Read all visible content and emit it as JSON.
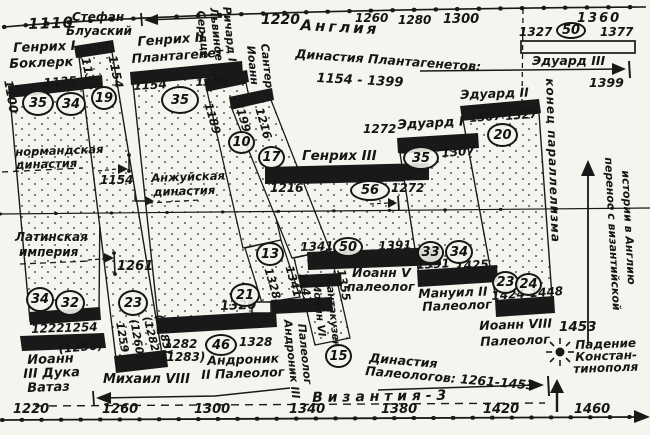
{
  "top_axis": {
    "region_label": "Англия",
    "ticks": [
      "1110",
      "1220",
      "1260",
      "1280",
      "1300",
      "1360"
    ]
  },
  "bottom_axis": {
    "region_label": "В и з а н т и я - 3",
    "ticks": [
      "1220",
      "1260",
      "1300",
      "1340",
      "1380",
      "1420",
      "1460"
    ]
  },
  "england": {
    "dynasty_label": "Династия Плантагенетов:",
    "dynasty_span": "1154 - 1399",
    "dynasty_end_year": "1399",
    "norman_line1": "нормандская",
    "norman_line2": "династия",
    "angevin_line1": "Анжуйская",
    "angevin_line2": "династия",
    "angevin_start": "1154",
    "henry1": {
      "line1": "Генрих I",
      "line2": "Боклерк",
      "start_vert": "1100",
      "end": "1135",
      "dur1": "35",
      "dur2": "34"
    },
    "stephen": {
      "line1": "Стефан",
      "line2": "Блуаский",
      "start_vert": "1135",
      "end_vert": "1154",
      "dur": "19"
    },
    "henry2": {
      "line1": "Генрих II",
      "line2": "Плантагенет",
      "start": "1154",
      "end": "1189",
      "dur": "35"
    },
    "richard": {
      "col1": "Сердце",
      "col2": "Львиное",
      "col3": "Ричард I",
      "start_vert": "1189",
      "end_vert": "1199",
      "dur": "10"
    },
    "john": {
      "col1": "Иоанн",
      "col2": "Сантер",
      "end_vert": "1216",
      "dur": "17"
    },
    "henry3": {
      "name": "Генрих III",
      "start": "1216",
      "dur": "56",
      "end": "1272"
    },
    "edward1": {
      "pre_year": "1272",
      "name": "Эдуард I",
      "dur": "35",
      "end": "1307"
    },
    "edward2": {
      "name": "Эдуард II",
      "start": "1307",
      "end": "1327",
      "dur": "20"
    },
    "edward3": {
      "name": "Эдуард III",
      "start": "1327",
      "dur": "50",
      "end": "1377"
    }
  },
  "byzantium": {
    "latin_line1": "Латинская",
    "latin_line2": "империя",
    "latin_end": "1261",
    "dynasty_line1": "Династия",
    "dynasty_line2": "Палеологов: 1261-1453",
    "john3": {
      "start": "1222",
      "end": "1254",
      "end_alt": "(1256)",
      "dur1": "34",
      "dur2": "32",
      "line1": "Иоанн",
      "line2": "III Дука",
      "line3": "Ватаз"
    },
    "michael8": {
      "dur": "23",
      "start_vert": "1259",
      "start_alt_vert": "(1260)",
      "end_vert": "(1282",
      "end_alt_vert": "(1283)",
      "name": "Михаил VIII"
    },
    "andronik2": {
      "start": "1282",
      "start_alt": "(1283)",
      "dur": "46",
      "end": "1328",
      "line1": "Андроник",
      "line2": "II Палеолог"
    },
    "andronik3": {
      "dur_full": "21",
      "start_full": "1320",
      "dur": "13",
      "start_vert": "1328",
      "end_vert": "1341",
      "name_line1": "Андроник III",
      "name_line2": "Палеолог"
    },
    "kantakuzen": {
      "dur": "15",
      "start_vert": "1341",
      "line1": "Иоанн VI",
      "line2": "Кантакузен",
      "end_vert": "1355"
    },
    "john5": {
      "start": "1341",
      "dur": "50",
      "end": "1391",
      "line1": "Иоанн V",
      "line2": "палеолог"
    },
    "manuel2": {
      "dur1": "33",
      "dur2": "34",
      "start": "1391",
      "end": "1425",
      "line1": "Мануил II",
      "line2": "Палеолог"
    },
    "john8": {
      "dur1": "23",
      "dur2": "24",
      "span": "1424-1448",
      "line1": "Иоанн VIII",
      "line2": "Палеолог"
    },
    "fall": {
      "year": "1453",
      "line1": "Падение",
      "line2": "Констан-",
      "line3": "тинополя"
    }
  },
  "annotations": {
    "parallel_end": "конец параллелизма",
    "transfer_line1": "перенос с византийской",
    "transfer_line2": "истории в Англию"
  }
}
